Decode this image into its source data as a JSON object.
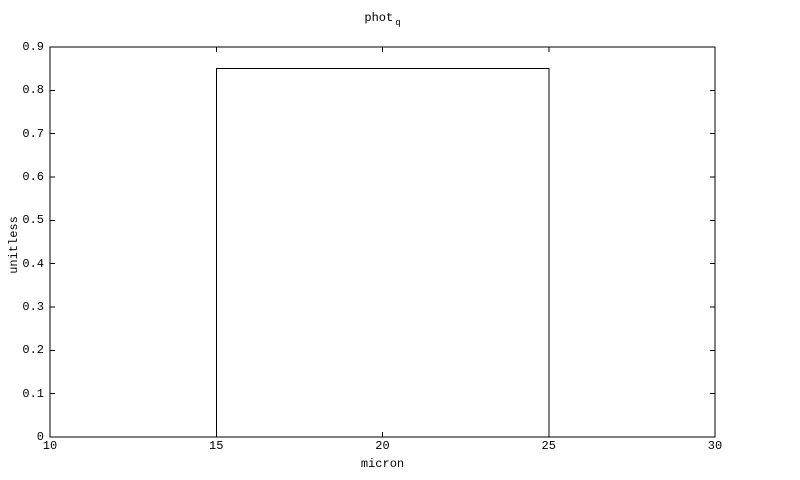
{
  "chart_data": {
    "type": "line",
    "title": "phot_q",
    "title_main": "phot",
    "title_sub": "q",
    "xlabel": "micron",
    "ylabel": "unitless",
    "xlim": [
      10,
      30
    ],
    "ylim": [
      0,
      0.9
    ],
    "xticks": [
      10,
      15,
      20,
      25,
      30
    ],
    "xtick_labels": [
      "10",
      "15",
      "20",
      "25",
      "30"
    ],
    "yticks": [
      0,
      0.1,
      0.2,
      0.3,
      0.4,
      0.5,
      0.6,
      0.7,
      0.8,
      0.9
    ],
    "ytick_labels": [
      "0",
      "0.1",
      "0.2",
      "0.3",
      "0.4",
      "0.5",
      "0.6",
      "0.7",
      "0.8",
      "0.9"
    ],
    "series": [
      {
        "name": "phot_q boxcar",
        "x": [
          10,
          15,
          15,
          25,
          25,
          30
        ],
        "y": [
          0,
          0,
          0.85,
          0.85,
          0,
          0
        ],
        "color": "#000000"
      }
    ],
    "grid": false,
    "legend": "none",
    "tick_style": "inward, all four sides",
    "background": "#ffffff",
    "frame_color": "#000000"
  }
}
